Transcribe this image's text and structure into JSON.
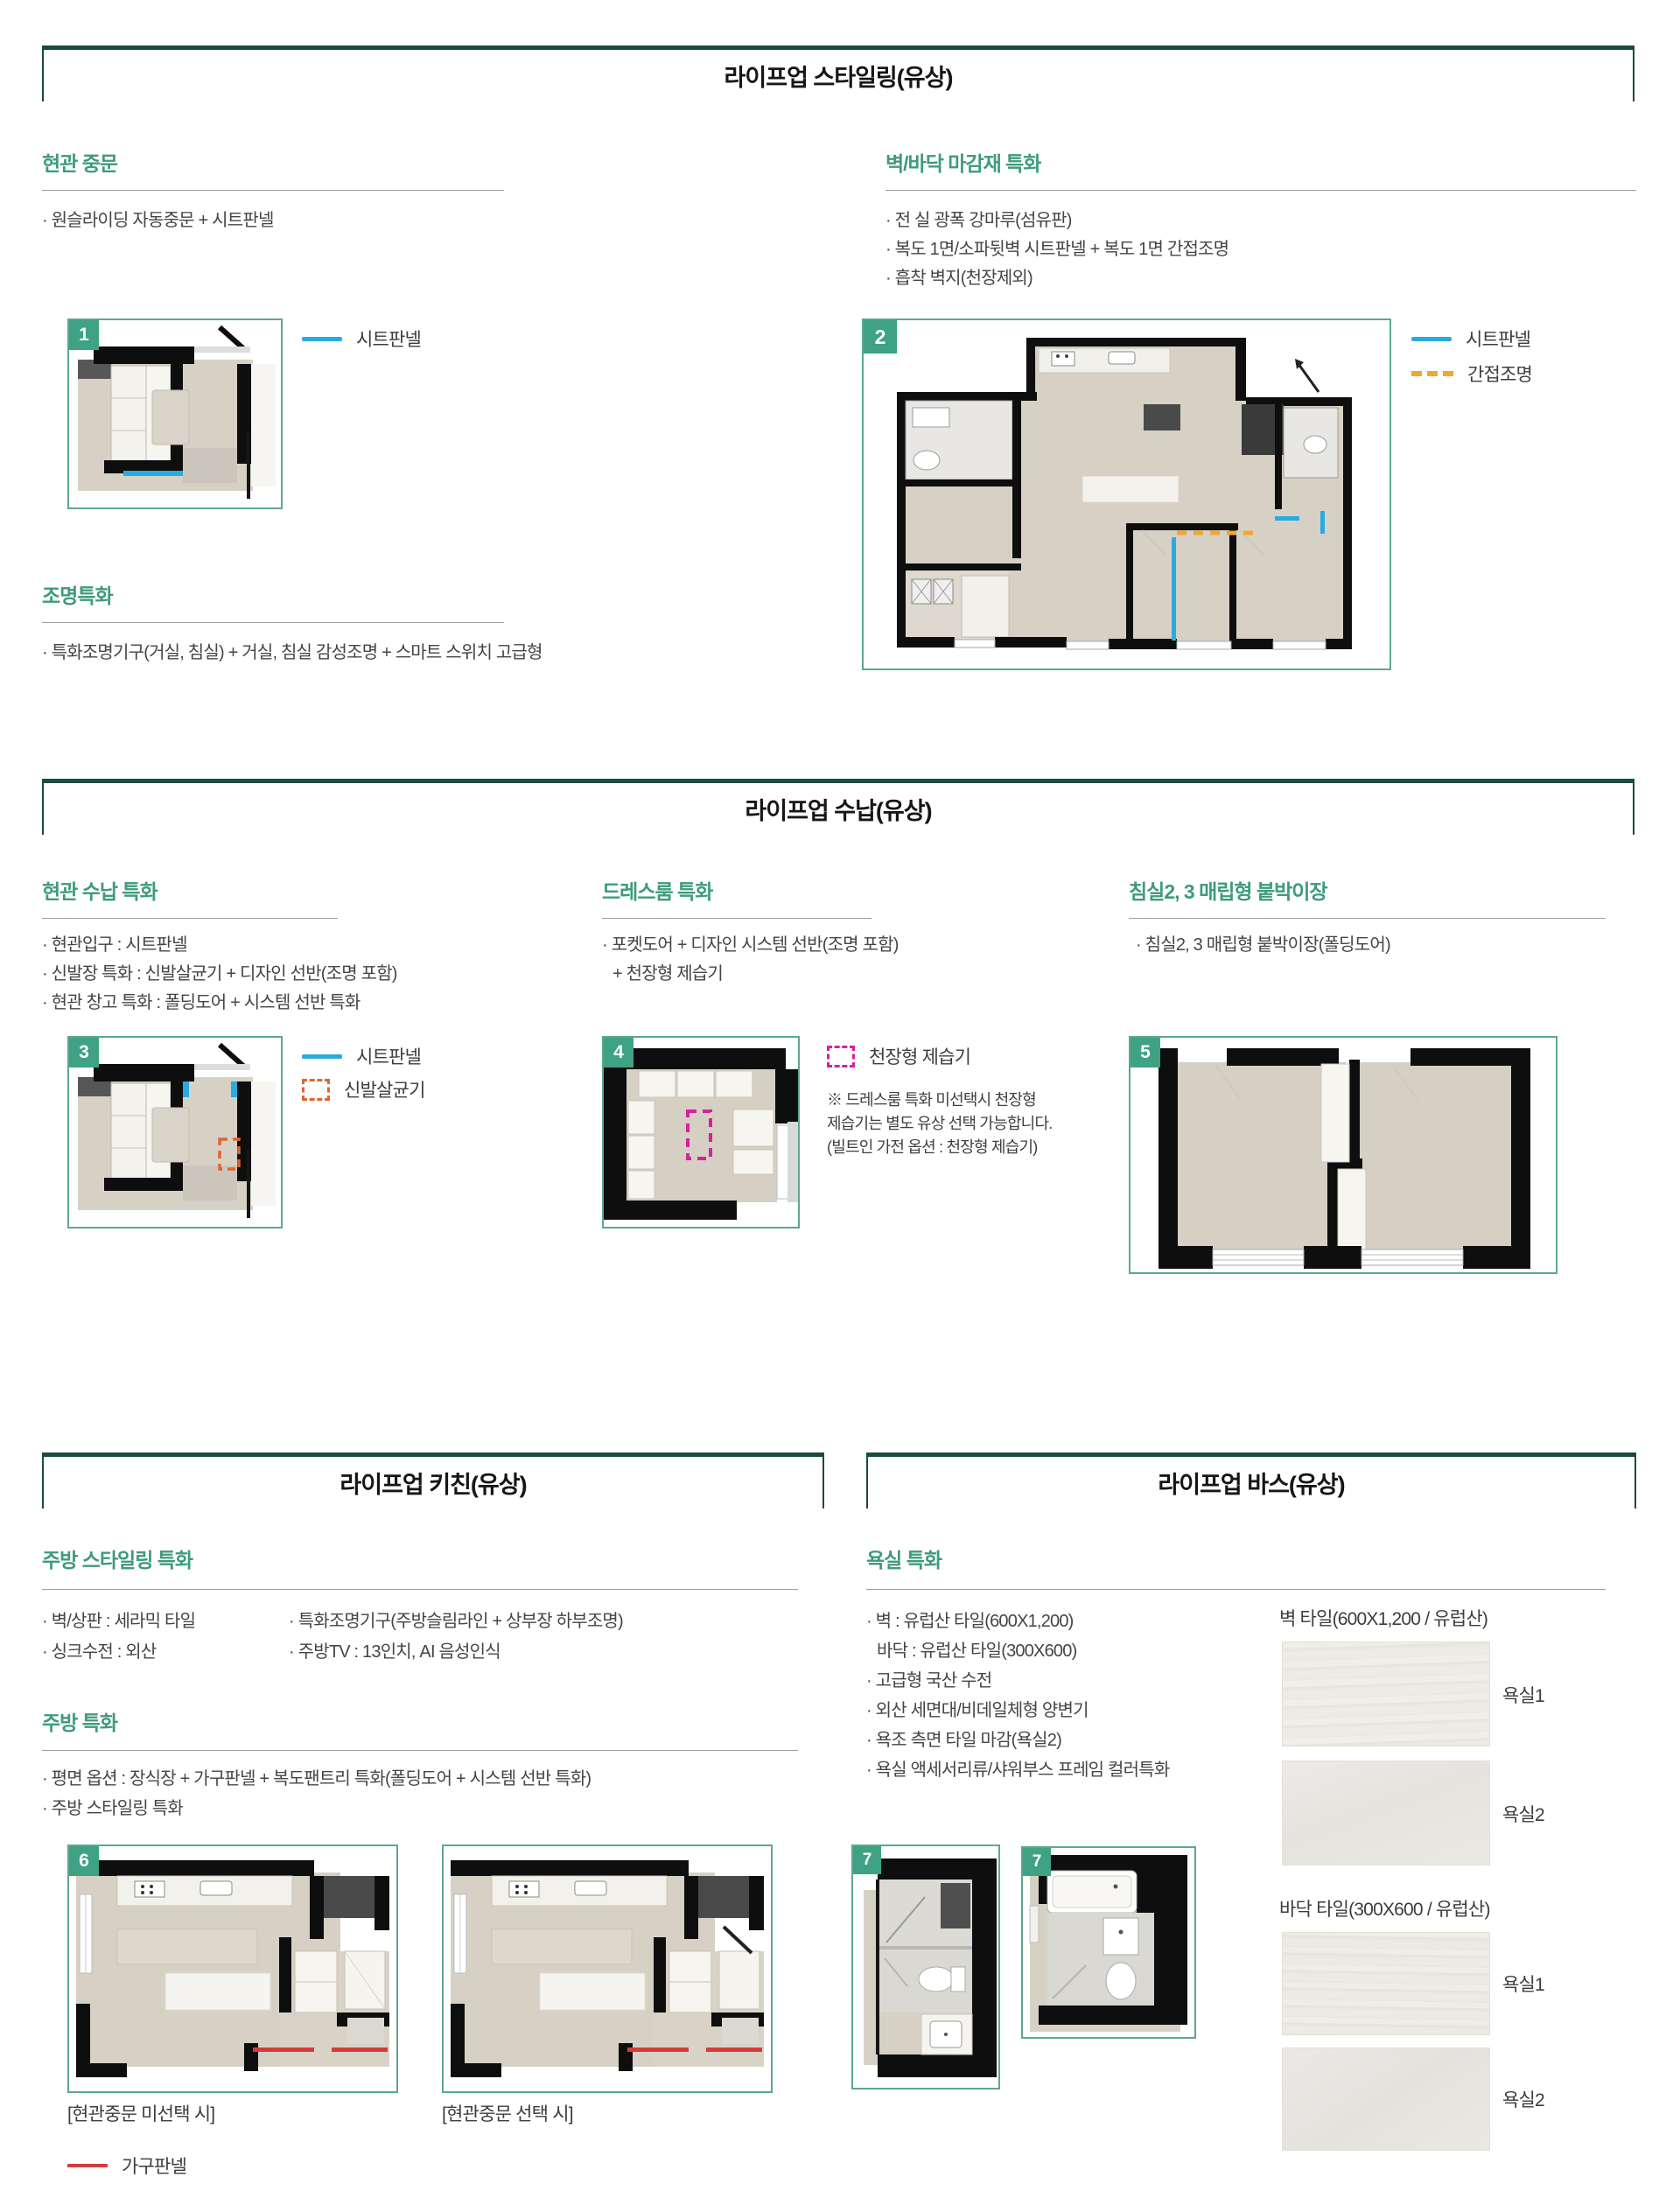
{
  "colors": {
    "heading_green": "#3E9B7B",
    "box_border": "#1B4A42",
    "badge_green": "#3FA284",
    "plan_border": "#5CA88C",
    "sheet_panel_cyan": "#29ABE2",
    "indirect_light_orange": "#F0A830",
    "shoe_sterilizer_orange": "#E06430",
    "dehumidifier_magenta": "#D6219C",
    "furniture_panel_red": "#D43C3C"
  },
  "styling": {
    "title": "라이프업 스타일링(유상)",
    "entrance": {
      "heading": "현관 중문",
      "bullet1": "· 원슬라이딩 자동중문 + 시트판넬",
      "plan_no": "1",
      "legend_sheet": "시트판넬"
    },
    "wallfloor": {
      "heading": "벽/바닥 마감재 특화",
      "bullet1": "· 전 실 광폭 강마루(섬유판)",
      "bullet2": "· 복도 1면/소파뒷벽 시트판넬 + 복도 1면 간접조명",
      "bullet3": "· 흡착 벽지(천장제외)",
      "plan_no": "2",
      "legend_sheet": "시트판넬",
      "legend_indirect": "간접조명"
    },
    "lighting": {
      "heading": "조명특화",
      "bullet1": "· 특화조명기구(거실, 침실) + 거실, 침실 감성조명 + 스마트 스위치 고급형"
    }
  },
  "storage": {
    "title": "라이프업 수납(유상)",
    "entrance": {
      "heading": "현관 수납 특화",
      "bullet1": "· 현관입구 : 시트판넬",
      "bullet2": "· 신발장 특화 : 신발살균기 + 디자인 선반(조명 포함)",
      "bullet3": "· 현관 창고 특화 : 폴딩도어 + 시스템 선반 특화",
      "plan_no": "3",
      "legend_sheet": "시트판넬",
      "legend_shoe": "신발살균기"
    },
    "dressroom": {
      "heading": "드레스룸 특화",
      "bullet1": "· 포켓도어 + 디자인 시스템 선반(조명 포함)",
      "bullet2": "+ 천장형 제습기",
      "plan_no": "4",
      "legend_dehumidifier": "천장형 제습기",
      "note1": "※ 드레스룸 특화 미선택시 천장형",
      "note2": "제습기는 별도 유상 선택 가능합니다.",
      "note3": "(빌트인 가전 옵션 : 천장형 제습기)"
    },
    "bedroom": {
      "heading": "침실2, 3 매립형 붙박이장",
      "bullet1": "· 침실2, 3 매립형 붙박이장(폴딩도어)",
      "plan_no": "5"
    }
  },
  "kitchen": {
    "title": "라이프업 키친(유상)",
    "styling": {
      "heading": "주방 스타일링 특화",
      "col1_bullet1": "· 벽/상판 : 세라믹 타일",
      "col1_bullet2": "· 싱크수전 : 외산",
      "col2_bullet1": "· 특화조명기구(주방슬림라인 + 상부장 하부조명)",
      "col2_bullet2": "· 주방TV : 13인치, AI 음성인식"
    },
    "special": {
      "heading": "주방 특화",
      "bullet1": "· 평면 옵션 : 장식장 + 가구판넬 + 복도팬트리 특화(폴딩도어 + 시스템 선반 특화)",
      "bullet2": "· 주방 스타일링 특화",
      "plan_no": "6",
      "caption1": "[현관중문 미선택 시]",
      "caption2": "[현관중문 선택 시]",
      "legend_furniture": "가구판넬"
    }
  },
  "bath": {
    "title": "라이프업 바스(유상)",
    "special": {
      "heading": "욕실 특화",
      "bullet1": "· 벽 : 유럽산 타일(600X1,200)",
      "bullet2": "바닥 : 유럽산 타일(300X600)",
      "bullet3": "· 고급형 국산 수전",
      "bullet4": "· 외산 세면대/비데일체형 양변기",
      "bullet5": "· 욕조 측면 타일 마감(욕실2)",
      "bullet6": "· 욕실 액세서리류/샤워부스 프레임 컬러특화",
      "plan_no_a": "7",
      "plan_no_b": "7"
    },
    "tiles": {
      "wall_label": "벽 타일(600X1,200 / 유럽산)",
      "floor_label": "바닥 타일(300X600 / 유럽산)",
      "wall_tile1": "욕실1",
      "wall_tile2": "욕실2",
      "floor_tile1": "욕실1",
      "floor_tile2": "욕실2"
    }
  }
}
